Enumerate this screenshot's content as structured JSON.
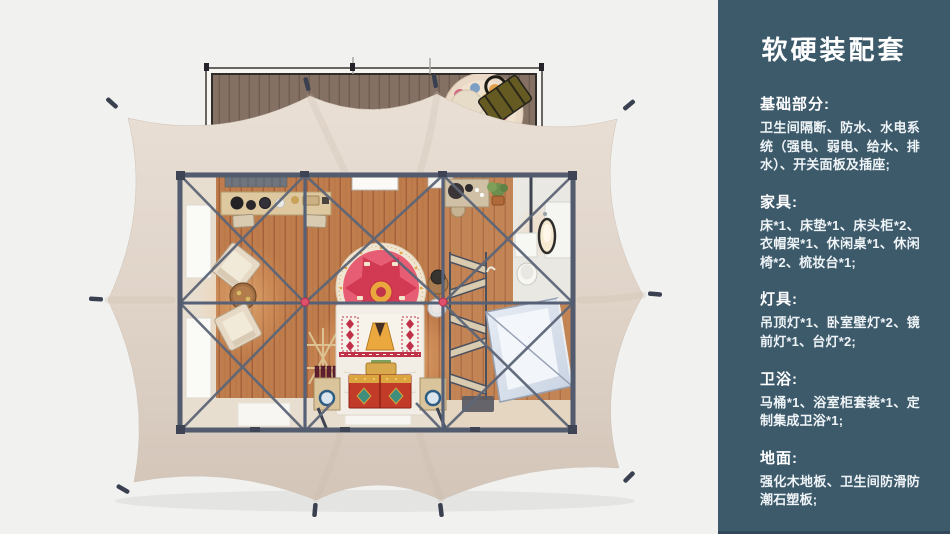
{
  "panel": {
    "title": "软硬装配套",
    "sections": [
      {
        "heading": "基础部分:",
        "body": "卫生间隔断、防水、水电系统（强电、弱电、给水、排水）、开关面板及插座;"
      },
      {
        "heading": "家具:",
        "body": "床*1、床垫*1、床头柜*2、衣帽架*1、休闲桌*1、休闲椅*2、梳妆台*1;"
      },
      {
        "heading": "灯具:",
        "body": "吊顶灯*1、卧室壁灯*2、镜前灯*1、台灯*2;"
      },
      {
        "heading": "卫浴:",
        "body": "马桶*1、浴室柜套装*1、定制集成卫浴*1;"
      },
      {
        "heading": "地面:",
        "body": "强化木地板、卫生间防滑防潮石塑板;"
      }
    ]
  },
  "colors": {
    "panel_bg": "#3d5a6b",
    "page_bg": "#f1f1ef",
    "canopy_beige": "#e0d4c9",
    "steel_frame": "#5a6476",
    "wood_floor": "#bf7c4c",
    "joint_accent": "#e0506a"
  }
}
